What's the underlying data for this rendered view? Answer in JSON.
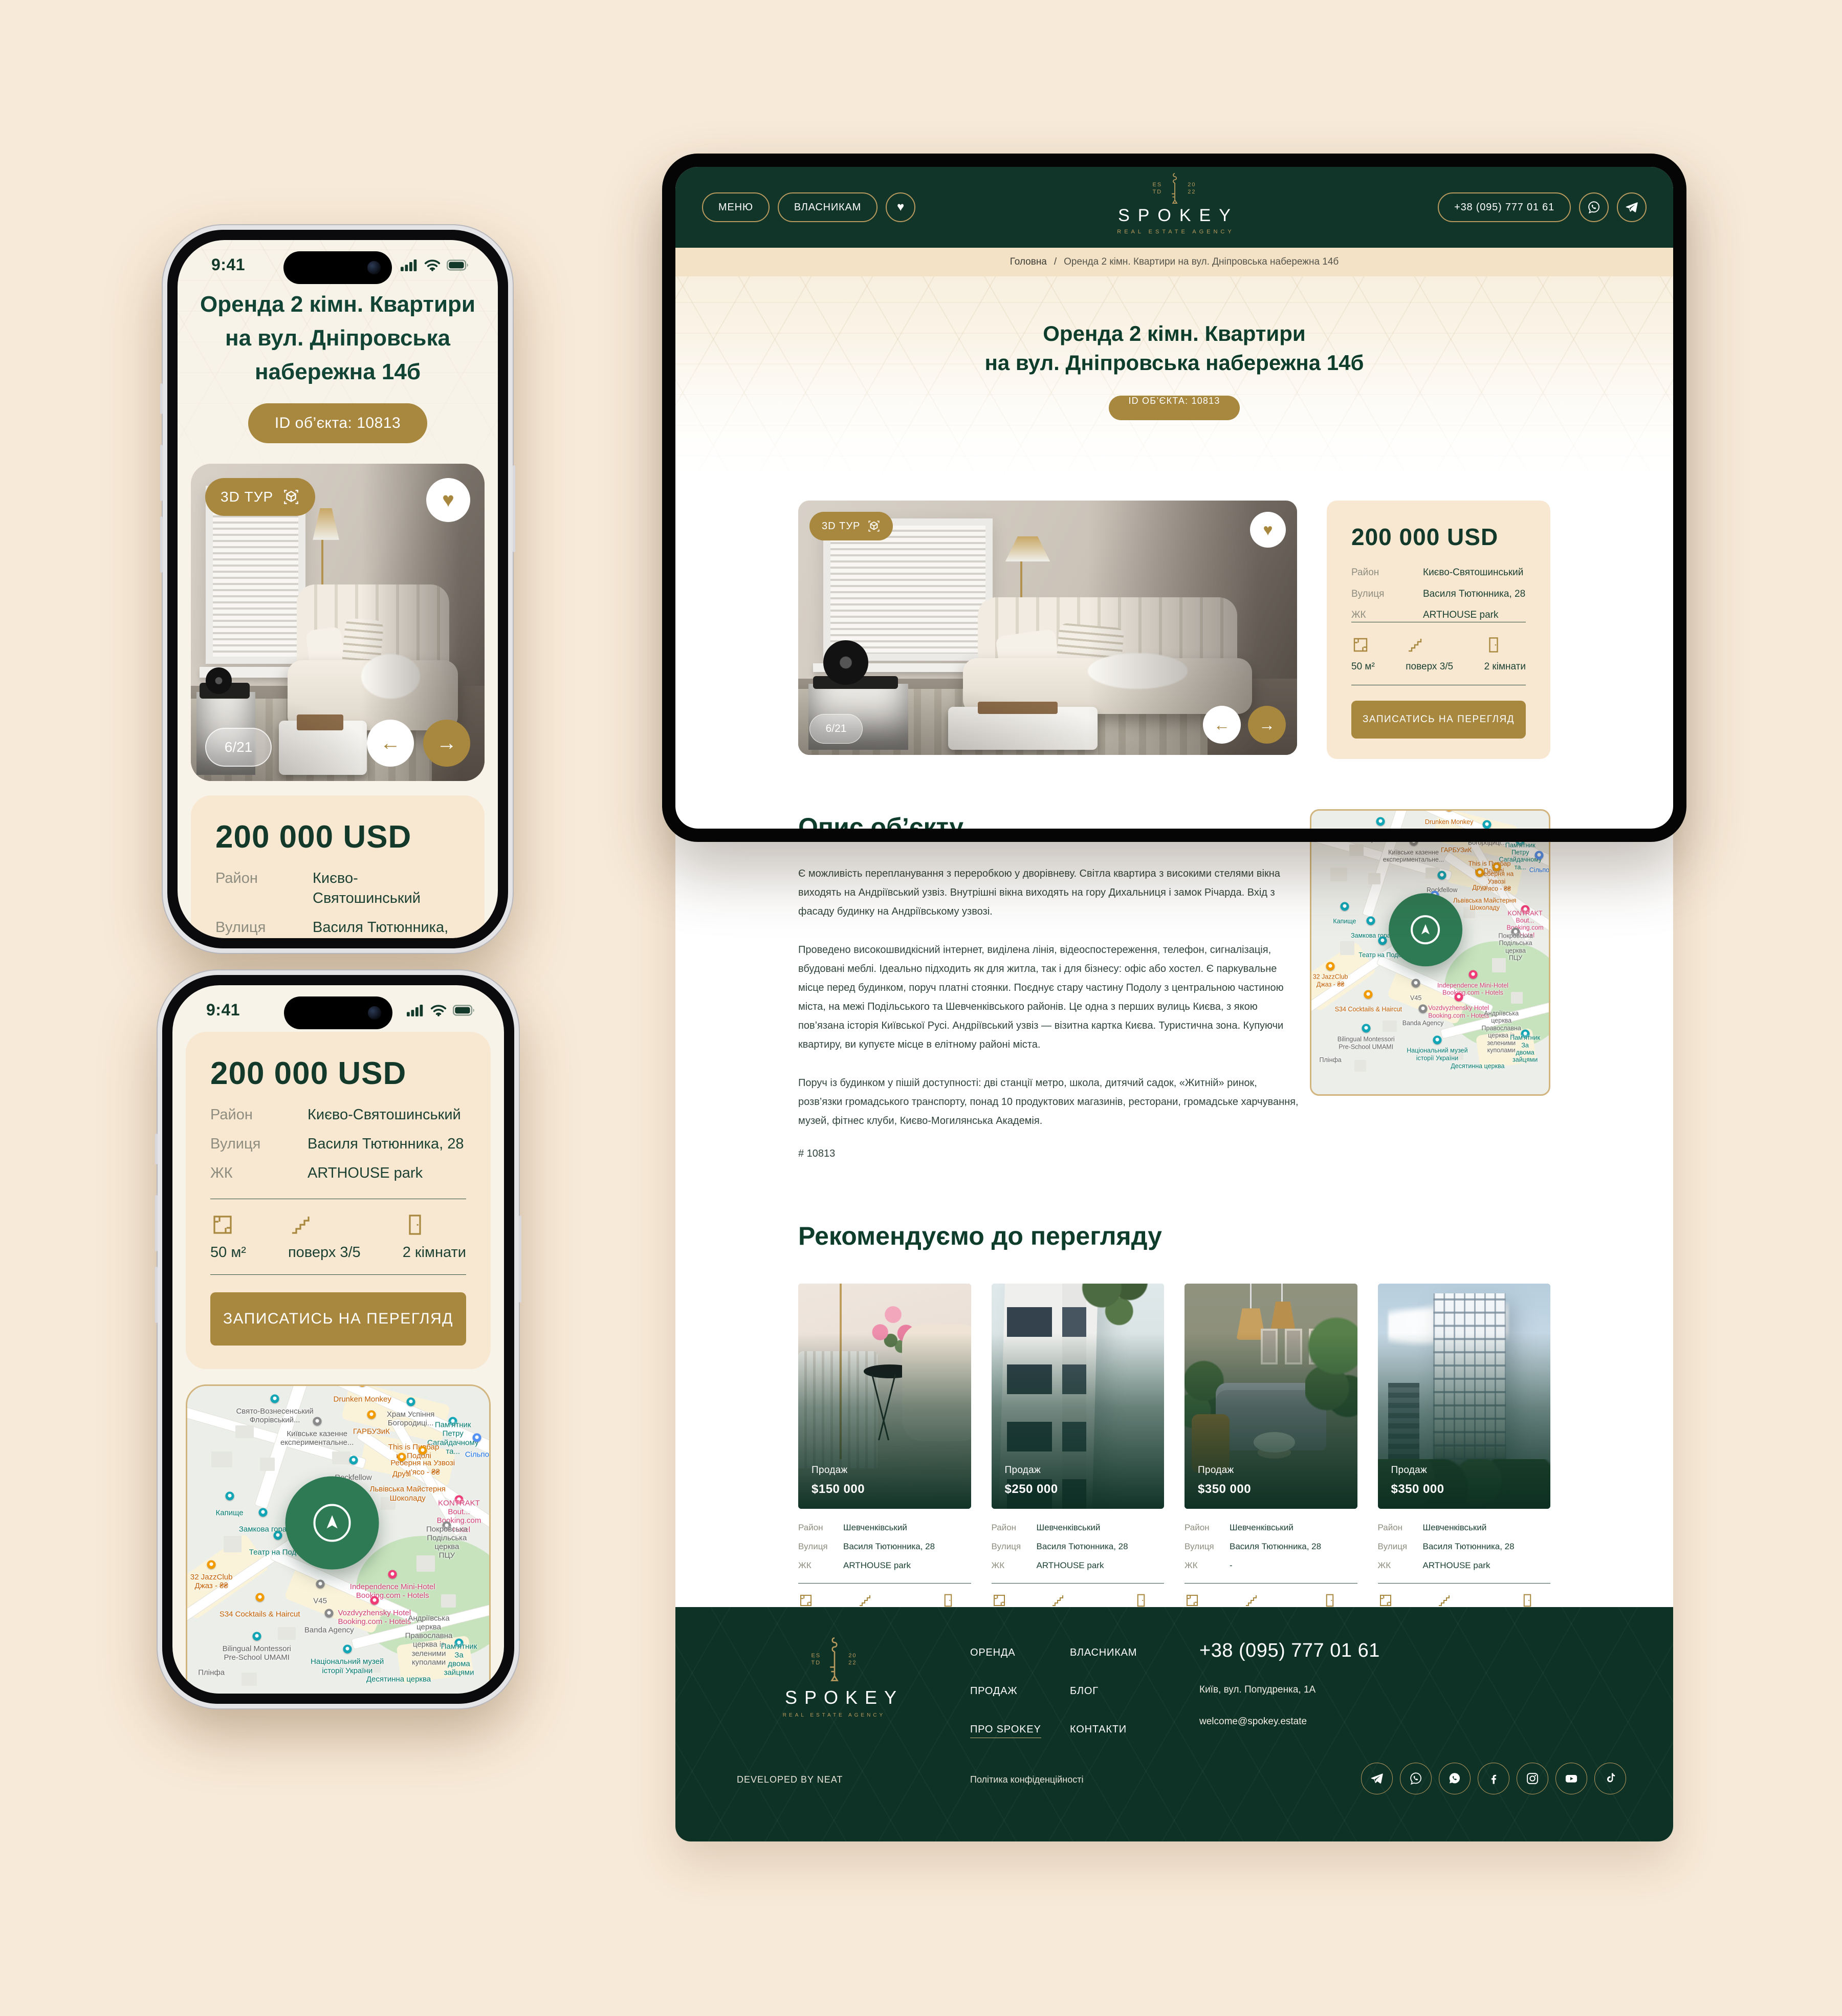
{
  "brand": {
    "name": "SPOKEY",
    "tagline": "REAL ESTATE AGENCY",
    "estd_left": "ES\nTD",
    "estd_right": "20\n22",
    "accent_gold": "#a8873e",
    "dark_green": "#113629"
  },
  "phone1": {
    "status_time": "9:41",
    "title": "Оренда 2 кімн. Квартири\nна вул. Дніпровська\nнабережна 14б",
    "id_badge": "ID об’єкта: 10813",
    "gallery": {
      "tour_label": "3D ТУР",
      "counter": "6/21",
      "heart_icon": "heart",
      "prev_icon": "←",
      "next_icon": "→"
    },
    "price": "200 000 USD",
    "rows": [
      {
        "label": "Район",
        "value": "Києво-Святошинський"
      },
      {
        "label": "Вулиця",
        "value": "Василя Тютюнника, 28"
      },
      {
        "label": "ЖК",
        "value": "ARTHOUSE park"
      }
    ]
  },
  "phone2": {
    "status_time": "9:41",
    "price": "200 000 USD",
    "rows": [
      {
        "label": "Район",
        "value": "Києво-Святошинський"
      },
      {
        "label": "Вулиця",
        "value": "Василя Тютюнника, 28"
      },
      {
        "label": "ЖК",
        "value": "ARTHOUSE park"
      }
    ],
    "features": [
      {
        "icon": "area",
        "value": "50 м²"
      },
      {
        "icon": "stairs",
        "value": "поверх 3/5"
      },
      {
        "icon": "door",
        "value": "2 кімнати"
      }
    ],
    "cta": "ЗАПИСАТИСЬ НА ПЕРЕГЛЯД",
    "section_heading": "Опис об’єкту"
  },
  "desktop": {
    "header": {
      "menu": "МЕНЮ",
      "owners": "ВЛАСНИКАМ",
      "phone": "+38 (095) 777 01 61"
    },
    "breadcrumb": {
      "home": "Головна",
      "separator": "/",
      "current": "Оренда 2 кімн. Квартири на вул. Дніпровська набережна 14б"
    },
    "hero": {
      "title": "Оренда 2 кімн. Квартири\nна вул. Дніпровська набережна 14б",
      "id_badge": "ID ОБ’ЄКТА: 10813"
    },
    "listing": {
      "tour_label": "3D ТУР",
      "counter": "6/21",
      "price": "200 000 USD",
      "rows": [
        {
          "label": "Район",
          "value": "Києво-Святошинський"
        },
        {
          "label": "Вулиця",
          "value": "Василя Тютюнника, 28"
        },
        {
          "label": "ЖК",
          "value": "ARTHOUSE park"
        }
      ],
      "features": [
        {
          "icon": "area",
          "value": "50 м²"
        },
        {
          "icon": "stairs",
          "value": "поверх 3/5"
        },
        {
          "icon": "door",
          "value": "2 кімнати"
        }
      ],
      "cta": "ЗАПИСАТИСЬ НА ПЕРЕГЛЯД"
    },
    "description": {
      "heading": "Опис об’єкту",
      "paragraphs": [
        "Є можливість перепланування з переробкою у дворівневу.\nСвітла квартира з високими стелями вікна виходять на Андріївський узвіз.\nВнутрішні вікна виходять на гору Дихальниця і замок Річарда. Вхід з фасаду будинку\nна Андріївському узвозі.",
        "Проведено високошвидкісний інтернет, виділена лінія, відеоспостереження, телефон,\nсигналізація, вбудовані меблі. Ідеально підходить як для житла, так і для бізнесу: офіс або хостел.\nЄ паркувальне місце перед будинком, поруч платні стоянки.\nПоєднує стару частину Подолу з центральною частиною міста, на межі Подільського\nта Шевченківського районів. Це одна з перших вулиць Києва, з якою пов’язана історія Київської\nРусі.\nАндріївський узвіз — візитна картка Києва. Туристична зона.\nКупуючи квартиру, ви купуєте місце в елітному районі міста.",
        "Поруч із будинком у пішій доступності: дві станції метро, школа, дитячий садок, «Житній» ринок,\nрозв’язки громадського транспорту, понад 10 продуктових магазинів, ресторани, громадське\nхарчування, музей, фітнес клуби, Києво-Могилянська Академія."
      ],
      "ref": "# 10813"
    },
    "recommended": {
      "heading": "Рекомендуємо до перегляду",
      "cards": [
        {
          "photo": "ph1",
          "deal": "Продаж",
          "price": "$150 000",
          "rows": [
            {
              "label": "Район",
              "value": "Шевченківський"
            },
            {
              "label": "Вулиця",
              "value": "Василя Тютюнника, 28"
            },
            {
              "label": "ЖК",
              "value": "ARTHOUSE park"
            }
          ],
          "features": [
            {
              "icon": "area",
              "value": "125 м²"
            },
            {
              "icon": "stairs",
              "value": "поверх 12/20"
            },
            {
              "icon": "door",
              "value": "8 кімнат"
            }
          ]
        },
        {
          "photo": "ph2",
          "deal": "Продаж",
          "price": "$250 000",
          "rows": [
            {
              "label": "Район",
              "value": "Шевченківський"
            },
            {
              "label": "Вулиця",
              "value": "Василя Тютюнника, 28"
            },
            {
              "label": "ЖК",
              "value": "ARTHOUSE park"
            }
          ],
          "features": [
            {
              "icon": "area",
              "value": "125 м²"
            },
            {
              "icon": "stairs",
              "value": "поверх 12/20"
            },
            {
              "icon": "door",
              "value": "8 кімнат"
            }
          ]
        },
        {
          "photo": "ph3",
          "deal": "Продаж",
          "price": "$350 000",
          "rows": [
            {
              "label": "Район",
              "value": "Шевченківський"
            },
            {
              "label": "Вулиця",
              "value": "Василя Тютюнника, 28"
            },
            {
              "label": "ЖК",
              "value": "-"
            }
          ],
          "features": [
            {
              "icon": "area",
              "value": "78 м²"
            },
            {
              "icon": "stairs",
              "value": "поверх 3/5"
            },
            {
              "icon": "door",
              "value": "3 кімнати"
            }
          ]
        },
        {
          "photo": "ph4",
          "deal": "Продаж",
          "price": "$350 000",
          "rows": [
            {
              "label": "Район",
              "value": "Шевченківський"
            },
            {
              "label": "Вулиця",
              "value": "Василя Тютюнника, 28"
            },
            {
              "label": "ЖК",
              "value": "ARTHOUSE park"
            }
          ],
          "features": [
            {
              "icon": "area",
              "value": "45 м²"
            },
            {
              "icon": "stairs",
              "value": "поверх 2/12"
            },
            {
              "icon": "door",
              "value": "8 кімнат"
            }
          ]
        }
      ]
    },
    "footer": {
      "links_col1": [
        "ОРЕНДА",
        "ПРОДАЖ",
        "ПРО SPOKEY"
      ],
      "links_col2": [
        "ВЛАСНИКАМ",
        "БЛОГ",
        "КОНТАКТИ"
      ],
      "phone": "+38 (095) 777 01 61",
      "address": "Київ, вул. Попудренка, 1А",
      "email": "welcome@spokey.estate",
      "socials": [
        "telegram",
        "viber",
        "whatsapp",
        "facebook",
        "instagram",
        "youtube",
        "tiktok"
      ],
      "developed": "DEVELOPED BY NEAT",
      "privacy": "Політика конфіденційності"
    }
  },
  "map": {
    "labels": [
      {
        "t": "Drunken Monkey",
        "x": 58,
        "y": 2,
        "c": "o",
        "p": "o"
      },
      {
        "t": "Свято-Вознесенський\nФлорівський...",
        "x": 29,
        "y": 7,
        "c": "g",
        "p": "t"
      },
      {
        "t": "Храм Успіння\nБогородиці...",
        "x": 74,
        "y": 8,
        "c": "g",
        "p": "t"
      },
      {
        "t": "Пам'ятник Петру\nСагайдачному та...",
        "x": 88,
        "y": 14,
        "c": "t",
        "p": "t"
      },
      {
        "t": "Київське казенне\nекспериментальне...",
        "x": 43,
        "y": 14,
        "c": "g",
        "p": "g"
      },
      {
        "t": "ГАРБУЗиК",
        "x": 61,
        "y": 12,
        "c": "o",
        "p": "o"
      },
      {
        "t": "This is Пивбар\nна Подолі",
        "x": 75,
        "y": 18,
        "c": "o"
      },
      {
        "t": "Реберня на Узвозі\nм'ясо - ₴₴",
        "x": 78,
        "y": 23,
        "c": "o",
        "p": "o"
      },
      {
        "t": "Сільпо",
        "x": 96,
        "y": 19,
        "c": "b",
        "p": "b"
      },
      {
        "t": "Rockfellow",
        "x": 55,
        "y": 26,
        "c": "g",
        "p": "t"
      },
      {
        "t": "Друзі",
        "x": 71,
        "y": 25,
        "c": "o",
        "p": "o"
      },
      {
        "t": "Львівська Майстерня\nШоколаду",
        "x": 73,
        "y": 31,
        "c": "o"
      },
      {
        "t": "Качоровська\nСтор і Кафе",
        "x": 52,
        "y": 33,
        "c": "b",
        "p": "b"
      },
      {
        "t": "Капище",
        "x": 14,
        "y": 37,
        "c": "t",
        "p": "t"
      },
      {
        "t": "Замкова гора",
        "x": 25,
        "y": 42,
        "c": "t",
        "p": "t"
      },
      {
        "t": "KONTRAKT Bout...\nBooking.com - Hotel",
        "x": 90,
        "y": 38,
        "c": "p",
        "p": "p"
      },
      {
        "t": "Покровська Подільська\nцерква ПЦУ",
        "x": 86,
        "y": 46,
        "c": "g",
        "p": "g"
      },
      {
        "t": "Театр на Подолі",
        "x": 30,
        "y": 49,
        "c": "t",
        "p": "t"
      },
      {
        "t": "32 JazzClub\nДжаз - ₴₴",
        "x": 8,
        "y": 58,
        "c": "o",
        "p": "o"
      },
      {
        "t": "Independence Mini-Hotel\nBooking.com - Hotels",
        "x": 68,
        "y": 61,
        "c": "p",
        "p": "p"
      },
      {
        "t": "V45",
        "x": 44,
        "y": 64,
        "c": "g",
        "p": "g"
      },
      {
        "t": "S34 Cocktails & Haircut",
        "x": 24,
        "y": 68,
        "c": "o",
        "p": "o"
      },
      {
        "t": "Vozdvyzhensky Hotel\nBooking.com - Hotels",
        "x": 62,
        "y": 69,
        "c": "p",
        "p": "p"
      },
      {
        "t": "Banda Agency",
        "x": 47,
        "y": 73,
        "c": "g",
        "p": "g"
      },
      {
        "t": "Bilingual Montessori\nPre-School UMAMI",
        "x": 23,
        "y": 80,
        "c": "g",
        "p": "t"
      },
      {
        "t": "Андріївська церква\nПравославна церква із зеленими куполами",
        "x": 80,
        "y": 76,
        "c": "g"
      },
      {
        "t": "Пам'ятник За\nдвома зайцями",
        "x": 90,
        "y": 82,
        "c": "t",
        "p": "t"
      },
      {
        "t": "Національний музей\nісторії України",
        "x": 53,
        "y": 84,
        "c": "t",
        "p": "t"
      },
      {
        "t": "Десятинна церква",
        "x": 70,
        "y": 88,
        "c": "t"
      },
      {
        "t": "Плінфа",
        "x": 8,
        "y": 86,
        "c": "g"
      }
    ]
  }
}
